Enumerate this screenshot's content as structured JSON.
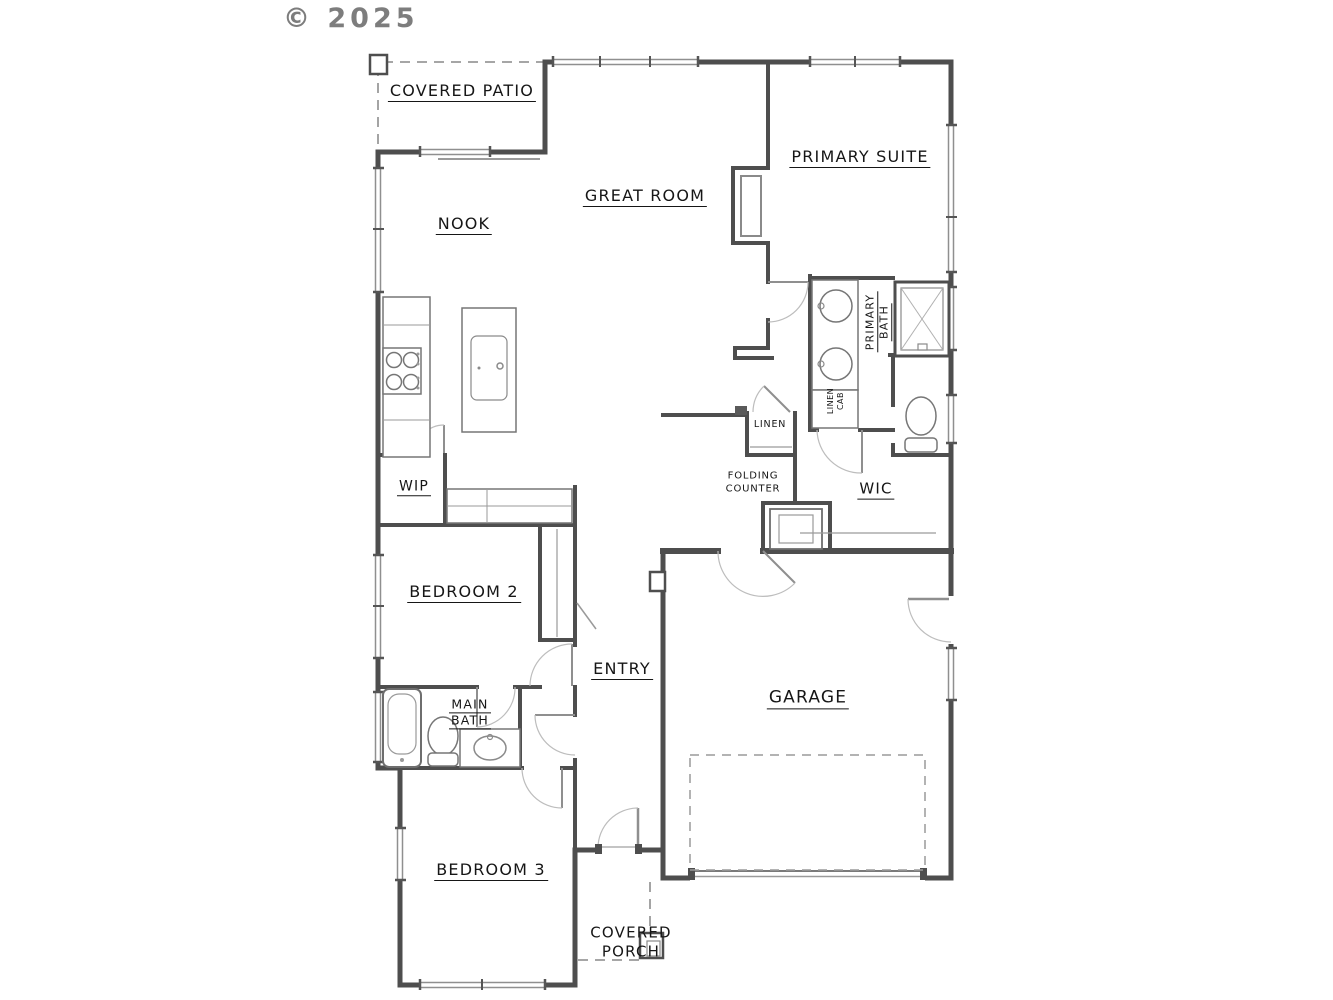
{
  "watermark": "© 2025",
  "plan": {
    "rooms": {
      "covered_patio": {
        "label": "COVERED PATIO"
      },
      "nook": {
        "label": "NOOK"
      },
      "great_room": {
        "label": "GREAT ROOM"
      },
      "primary_suite": {
        "label": "PRIMARY SUITE"
      },
      "primary_bath": {
        "line1": "PRIMARY",
        "line2": "BATH"
      },
      "linen_cab": {
        "line1": "LINEN",
        "line2": "CAB"
      },
      "linen": {
        "label": "LINEN"
      },
      "folding_counter": {
        "line1": "FOLDING",
        "line2": "COUNTER"
      },
      "wic": {
        "label": "WIC"
      },
      "wip": {
        "label": "WIP"
      },
      "bedroom2": {
        "label": "BEDROOM 2"
      },
      "entry": {
        "label": "ENTRY"
      },
      "garage": {
        "label": "GARAGE"
      },
      "main_bath": {
        "line1": "MAIN",
        "line2": "BATH"
      },
      "bedroom3": {
        "label": "BEDROOM 3"
      },
      "covered_porch": {
        "line1": "COVERED",
        "line2": "PORCH"
      }
    },
    "fixtures": [
      "range-cooktop",
      "island-sink",
      "double-vanity-sinks",
      "shower",
      "toilet",
      "linen-cabinet",
      "water-heater",
      "bathtub",
      "vanity-sink",
      "fireplace-niche",
      "kitchen-counter",
      "folding-counter",
      "garage-door",
      "front-door"
    ],
    "colors": {
      "wall": "#4e4e4e",
      "thin": "#767676",
      "dash": "#9a9a9a",
      "text": "#161616"
    }
  }
}
